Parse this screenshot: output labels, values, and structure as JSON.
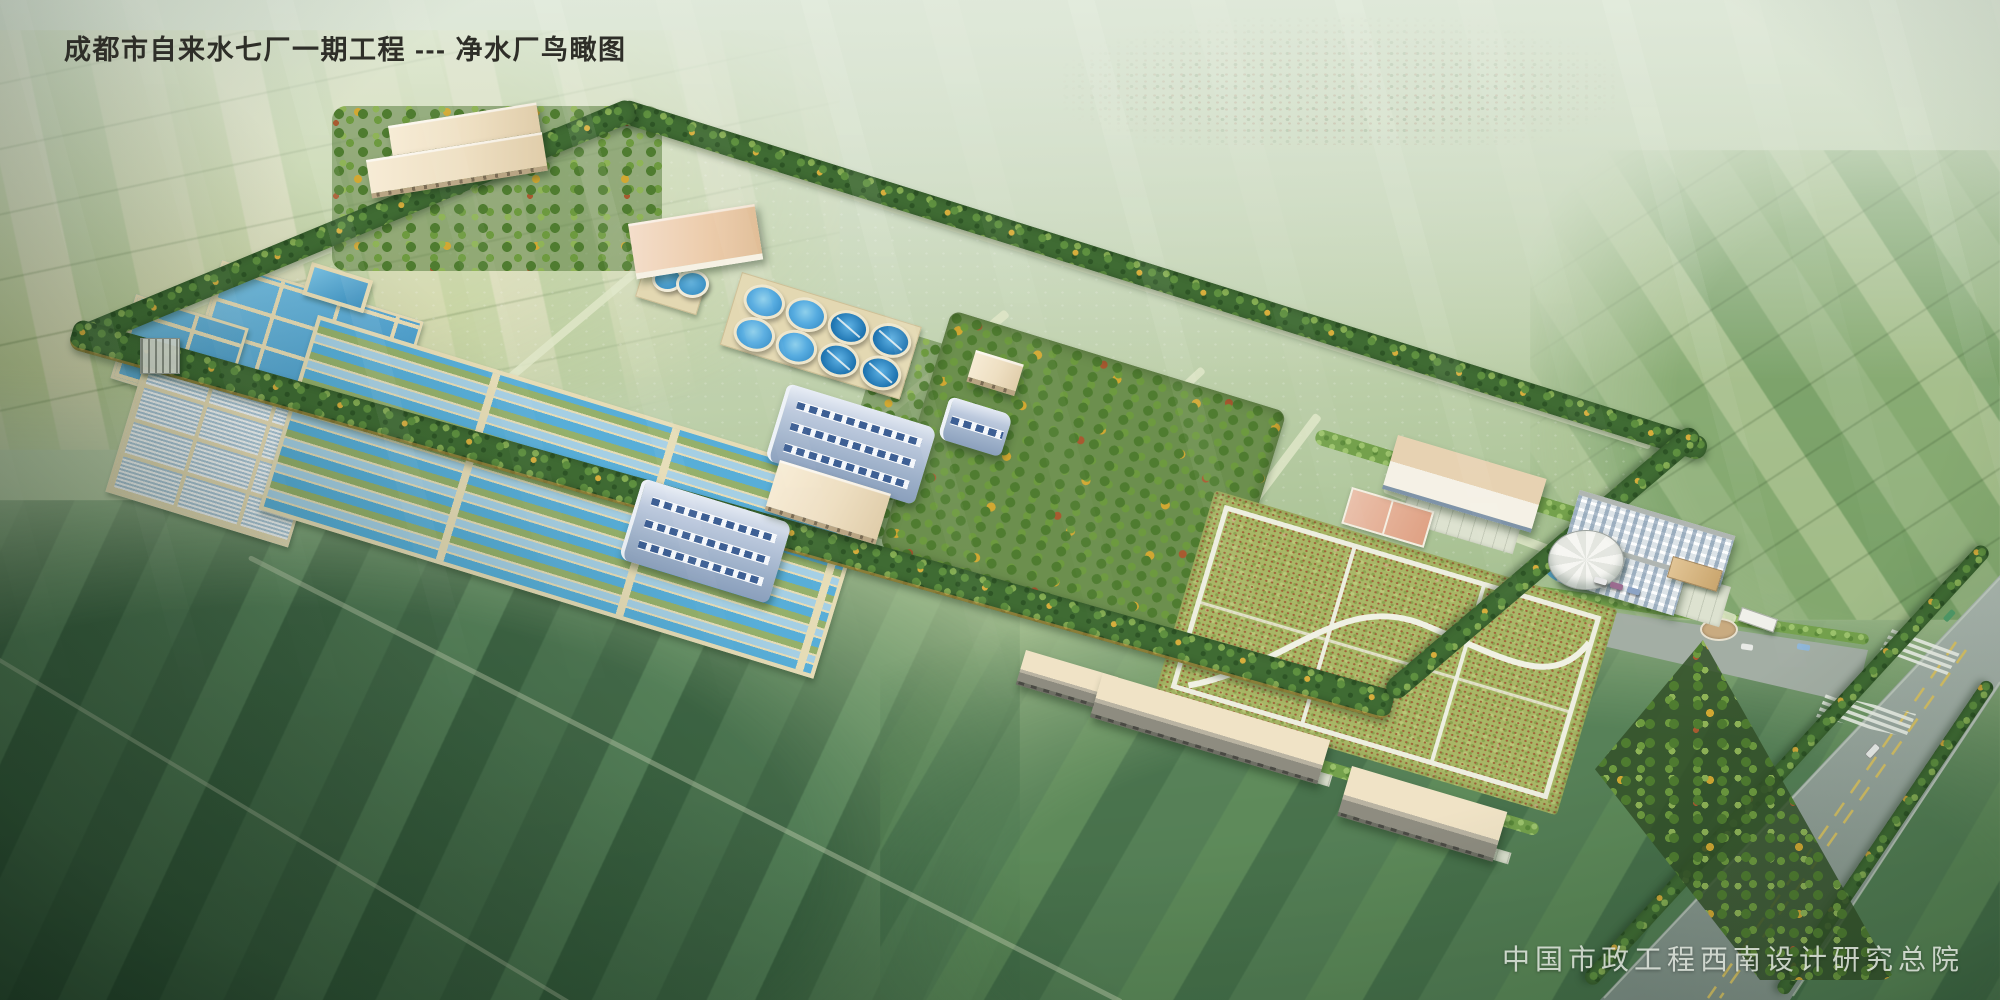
{
  "header": {
    "title": "成都市自来水七厂一期工程 --- 净水厂鸟瞰图"
  },
  "footer": {
    "credit": "中国市政工程西南设计研究总院"
  },
  "palette": {
    "water": "#57ace0",
    "clarifier_water": "#2f86c2",
    "tank_edge": "#e6dcb6",
    "roof_blue": "#9db0c9",
    "roof_cream": "#efe0c4",
    "roof_tan": "#e0c8a6",
    "wall_white": "#f3f5f3",
    "tree_dark": "#3f6b33",
    "tree_light": "#87b054",
    "tree_autumn": "#d7ae3c",
    "orchard_green": "#6c8f4e",
    "lawn_green": "#a8b766",
    "road_asphalt": "#97a59d",
    "road_centerline": "#d8c266",
    "field_yellow": "#d2d6a2",
    "field_green": "#7da468",
    "haze": "#dfe8d9",
    "title_text": "#2e2e28",
    "credit_text": "#e4eae2"
  }
}
